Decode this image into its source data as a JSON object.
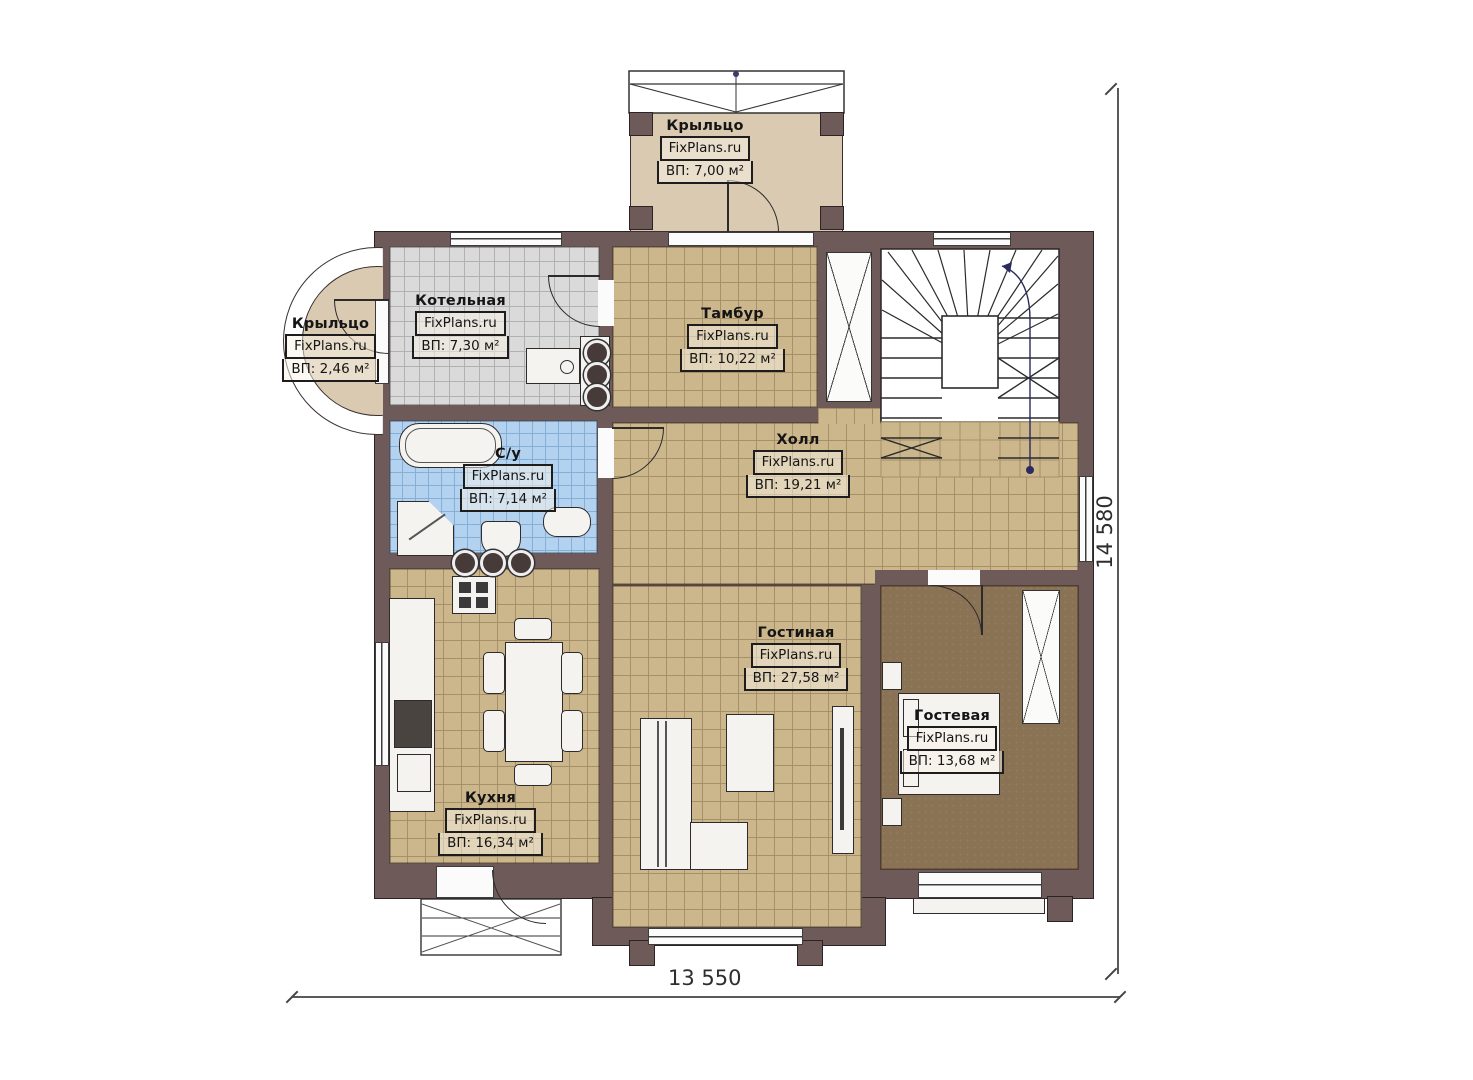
{
  "plan": {
    "brand": "FixPlans.ru",
    "rooms": {
      "porch_top": {
        "name": "Крыльцо",
        "area": "ВП: 7,00 м²"
      },
      "porch_left": {
        "name": "Крыльцо",
        "area": "ВП: 2,46 м²"
      },
      "boiler": {
        "name": "Котельная",
        "area": "ВП: 7,30 м²"
      },
      "tambour": {
        "name": "Тамбур",
        "area": "ВП: 10,22 м²"
      },
      "hall": {
        "name": "Холл",
        "area": "ВП: 19,21 м²"
      },
      "bathroom": {
        "name": "С/у",
        "area": "ВП: 7,14 м²"
      },
      "kitchen": {
        "name": "Кухня",
        "area": "ВП: 16,34 м²"
      },
      "living": {
        "name": "Гостиная",
        "area": "ВП: 27,58 м²"
      },
      "guest": {
        "name": "Гостевая",
        "area": "ВП: 13,68 м²"
      }
    },
    "dimensions": {
      "width_label": "13 550",
      "height_label": "14 580"
    },
    "colors": {
      "wall": "#6e5a59",
      "tile_tan": "#ccb68c",
      "tile_gray": "#dadada",
      "tile_blue": "#b3d2f0",
      "carpet": "#8a7254",
      "porch": "#d9cab1"
    }
  }
}
